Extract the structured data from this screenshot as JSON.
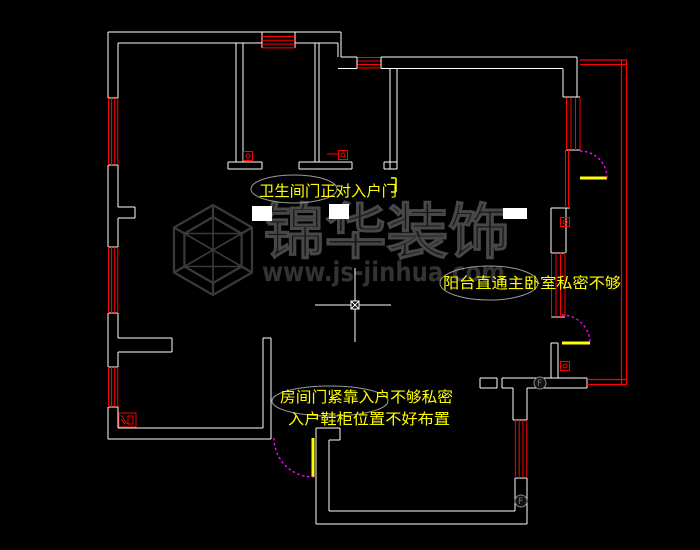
{
  "app": {
    "type": "cad-floorplan-review-screenshot",
    "background": "#000000"
  },
  "watermark": {
    "logo": "cube-wireframe-logo",
    "brand": "锦华装饰",
    "url": "www.js-jinhua.com"
  },
  "annotations": {
    "callout1": {
      "text": "卫生间门正对入户门"
    },
    "callout2": {
      "text": "阳台直通主卧室私密不够"
    },
    "callout3_line1": {
      "text": "房间门紧靠入户不够私密"
    },
    "callout3_line2": {
      "text": "入户鞋柜位置不好布置"
    }
  },
  "symbols": {
    "doors": [
      "entry-door",
      "master-balcony-door",
      "top-balcony-door",
      "bathroom2-door-mark"
    ],
    "windows": [
      "left-window-1",
      "left-window-2",
      "left-window-3",
      "top-window-1",
      "top-window-2",
      "top-right-window",
      "master-window",
      "bottom-right-window"
    ],
    "misc": [
      "floor-drain-1",
      "floor-drain-2",
      "wall-symbol-1",
      "wall-symbol-2",
      "appliance-symbol",
      "section-marker-1",
      "section-marker-2"
    ]
  },
  "colors": {
    "background": "#000000",
    "wall": "#ffffff",
    "window": "#ff0000",
    "balcony_rail": "#ff0000",
    "door_swing": "#ff00ff",
    "door_leaf": "#ffff00",
    "annotation_text": "#ffff00",
    "callout_ellipse": "#9a9a9a",
    "watermark": "#3a3a3a",
    "crosshair": "#ffffff"
  },
  "cursor": {
    "x": 355,
    "y": 305
  }
}
